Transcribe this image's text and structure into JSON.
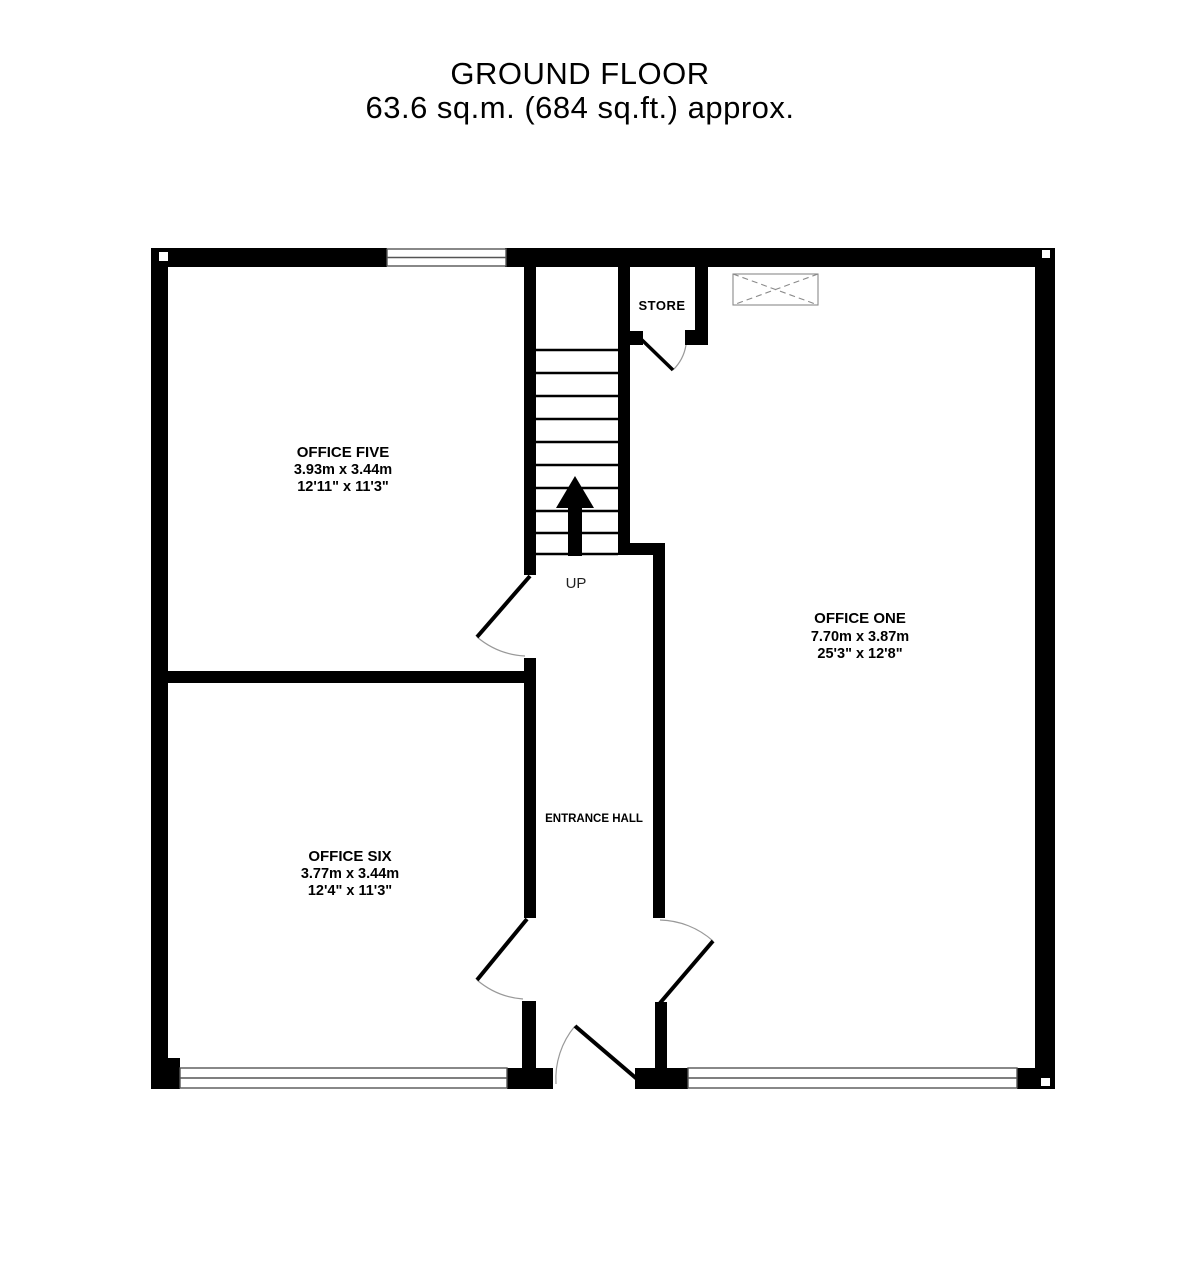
{
  "title": {
    "line1": "GROUND FLOOR",
    "line2": "63.6 sq.m. (684 sq.ft.) approx."
  },
  "rooms": {
    "office_five": {
      "name": "OFFICE FIVE",
      "metric": "3.93m  x 3.44m",
      "imperial": "12'11\"  x 11'3\""
    },
    "office_six": {
      "name": "OFFICE SIX",
      "metric": "3.77m  x 3.44m",
      "imperial": "12'4\"  x 11'3\""
    },
    "office_one": {
      "name": "OFFICE ONE",
      "metric": "7.70m  x 3.87m",
      "imperial": "25'3\"  x 12'8\""
    },
    "store": {
      "name": "STORE"
    },
    "entrance_hall": {
      "name": "ENTRANCE HALL"
    }
  },
  "stairs": {
    "direction_label": "UP"
  },
  "colors": {
    "walls": "#000000",
    "background": "#ffffff",
    "door_arc": "#999999",
    "window_outline": "#555555",
    "skylight_outline": "#8a8a8a",
    "text": "#000000"
  }
}
